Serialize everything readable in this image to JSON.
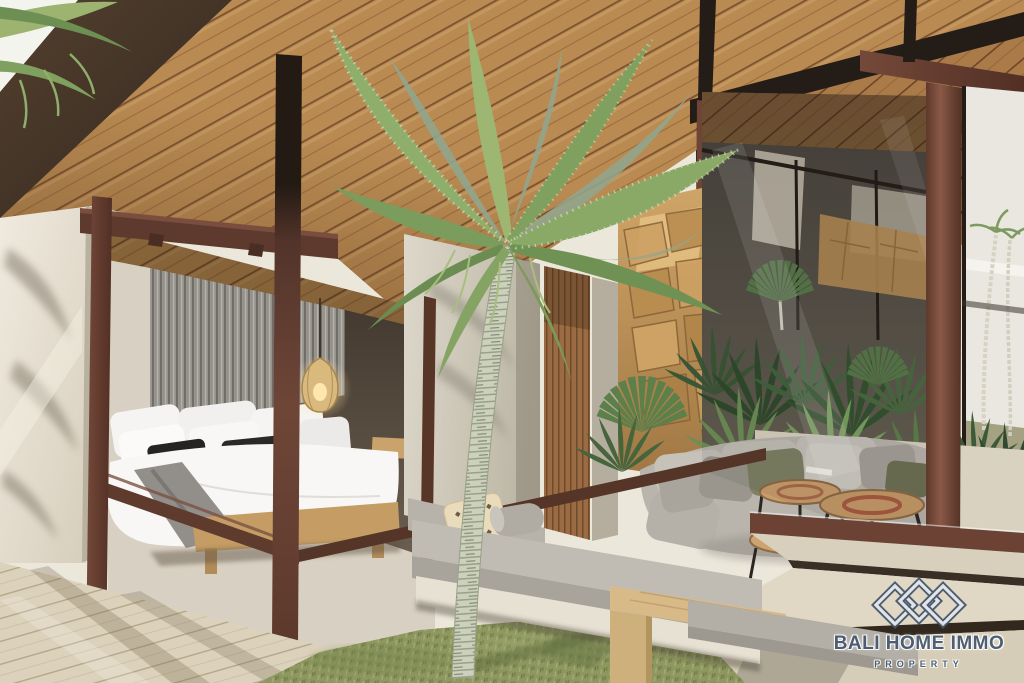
{
  "watermark": {
    "brand": "BALI HOME IMMO",
    "tagline": "PROPERTY"
  },
  "palette": {
    "ceiling_wood": "#b98a52",
    "roof_fascia_dark": "#463628",
    "steel_beam_black": "#241d17",
    "frame_maroon": "#6b4236",
    "wall_cream": "#e9e3d6",
    "slat_wall_gray": "#97938d",
    "bedding_white": "#f8f7f5",
    "accent_pillow_black": "#262422",
    "bed_base_wood": "#c49c64",
    "rock_tan": "#c09055",
    "foliage_green": "#7e9a5a",
    "sofa_gray": "#b9b5ad",
    "grass_green": "#8e9760",
    "deck_wood_pale": "#dcd2bb",
    "step_stone": "#ded5c2",
    "logo_navy": "#44566e"
  },
  "scene": {
    "objects": [
      "wood-plank-ceiling",
      "dark-roof-beams",
      "palm-tree",
      "bedroom-bed",
      "rattan-pendant-lamp",
      "glass-wall-frames",
      "rock-feature-wall",
      "tropical-plants",
      "lounge-sofa",
      "wood-slab-coffee-tables",
      "outdoor-daybed",
      "wooden-bench",
      "grass-lawn",
      "wood-deck",
      "stone-steps"
    ]
  }
}
